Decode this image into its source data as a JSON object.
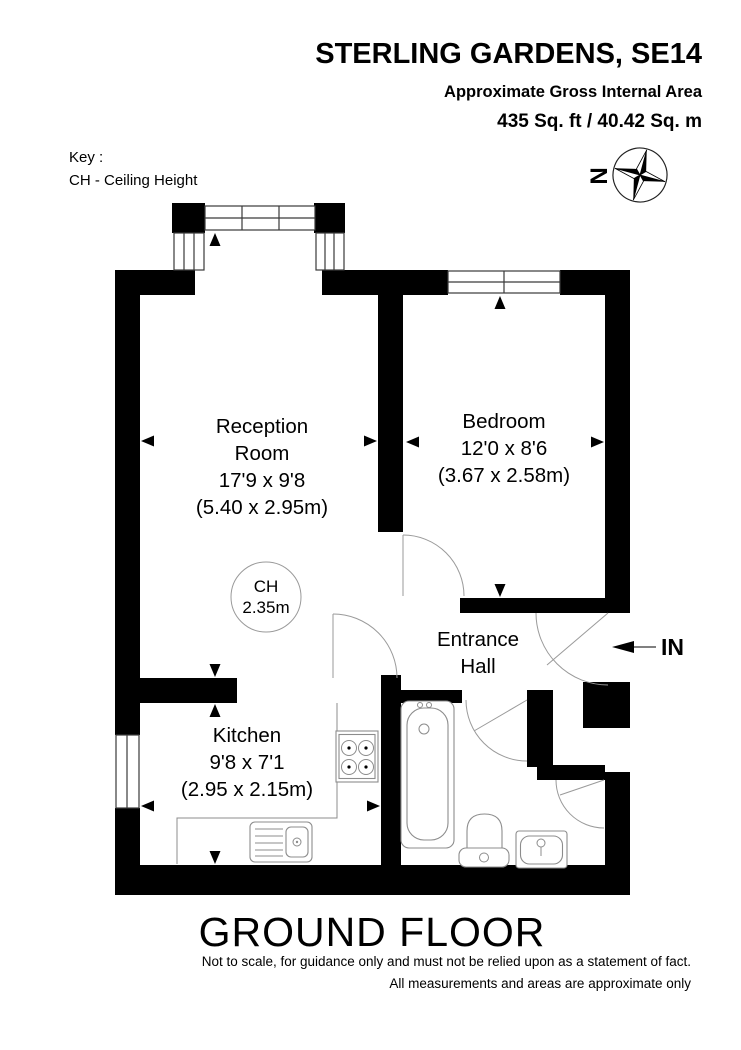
{
  "header": {
    "title": "STERLING GARDENS, SE14",
    "subtitle": "Approximate Gross Internal Area",
    "area": "435 Sq. ft / 40.42 Sq. m"
  },
  "key": {
    "label": "Key :",
    "entry": "CH - Ceiling Height"
  },
  "compass": {
    "north_label": "N"
  },
  "rooms": {
    "reception": {
      "line1": "Reception",
      "line2": "Room",
      "dims_imperial": "17'9 x 9'8",
      "dims_metric": "(5.40 x 2.95m)"
    },
    "bedroom": {
      "name": "Bedroom",
      "dims_imperial": "12'0 x 8'6",
      "dims_metric": "(3.67 x 2.58m)"
    },
    "kitchen": {
      "name": "Kitchen",
      "dims_imperial": "9'8 x 7'1",
      "dims_metric": "(2.95 x 2.15m)"
    },
    "entrance_hall": {
      "line1": "Entrance",
      "line2": "Hall"
    }
  },
  "ceiling_height": {
    "label": "CH",
    "value": "2.35m"
  },
  "entry_marker": {
    "label": "IN"
  },
  "floor": {
    "label": "GROUND FLOOR"
  },
  "disclaimer": {
    "line1": "Not to scale, for guidance only and must not be relied upon as a statement of fact.",
    "line2": "All measurements and areas are approximate only"
  },
  "colors": {
    "wall": "#000000",
    "background": "#ffffff",
    "fixture_line": "#8c8c8c",
    "door_line": "#9a9a9a"
  }
}
